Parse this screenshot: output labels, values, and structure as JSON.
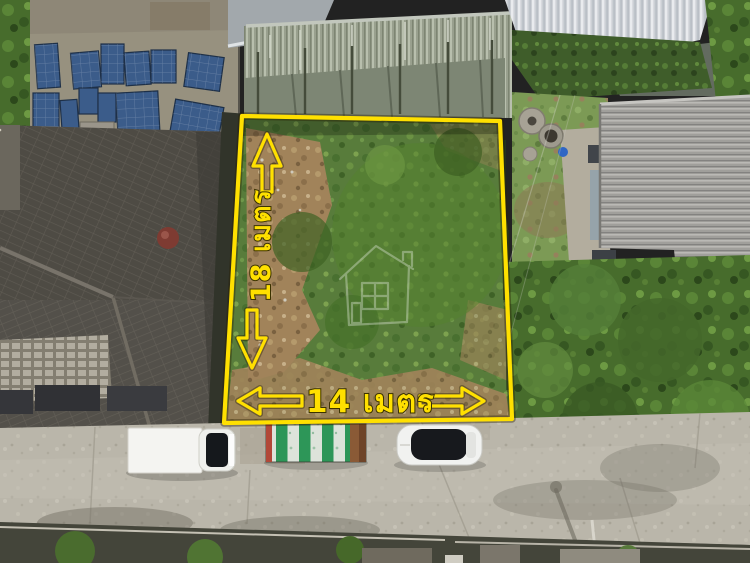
{
  "photo": {
    "kind": "aerial-drone-photo-of-vacant-land-plot",
    "annotations": {
      "side_length_label": "18 เมตร",
      "frontage_length_label": "14 เมตร"
    },
    "colors": {
      "boundary_yellow": "#ffe000",
      "label_outline": "#3b3200",
      "watermark_white": "#ffffff"
    },
    "icons": {
      "up_arrow": "↑",
      "down_arrow": "↓",
      "left_arrow": "←",
      "right_arrow": "→",
      "watermark": "house-outline"
    }
  }
}
